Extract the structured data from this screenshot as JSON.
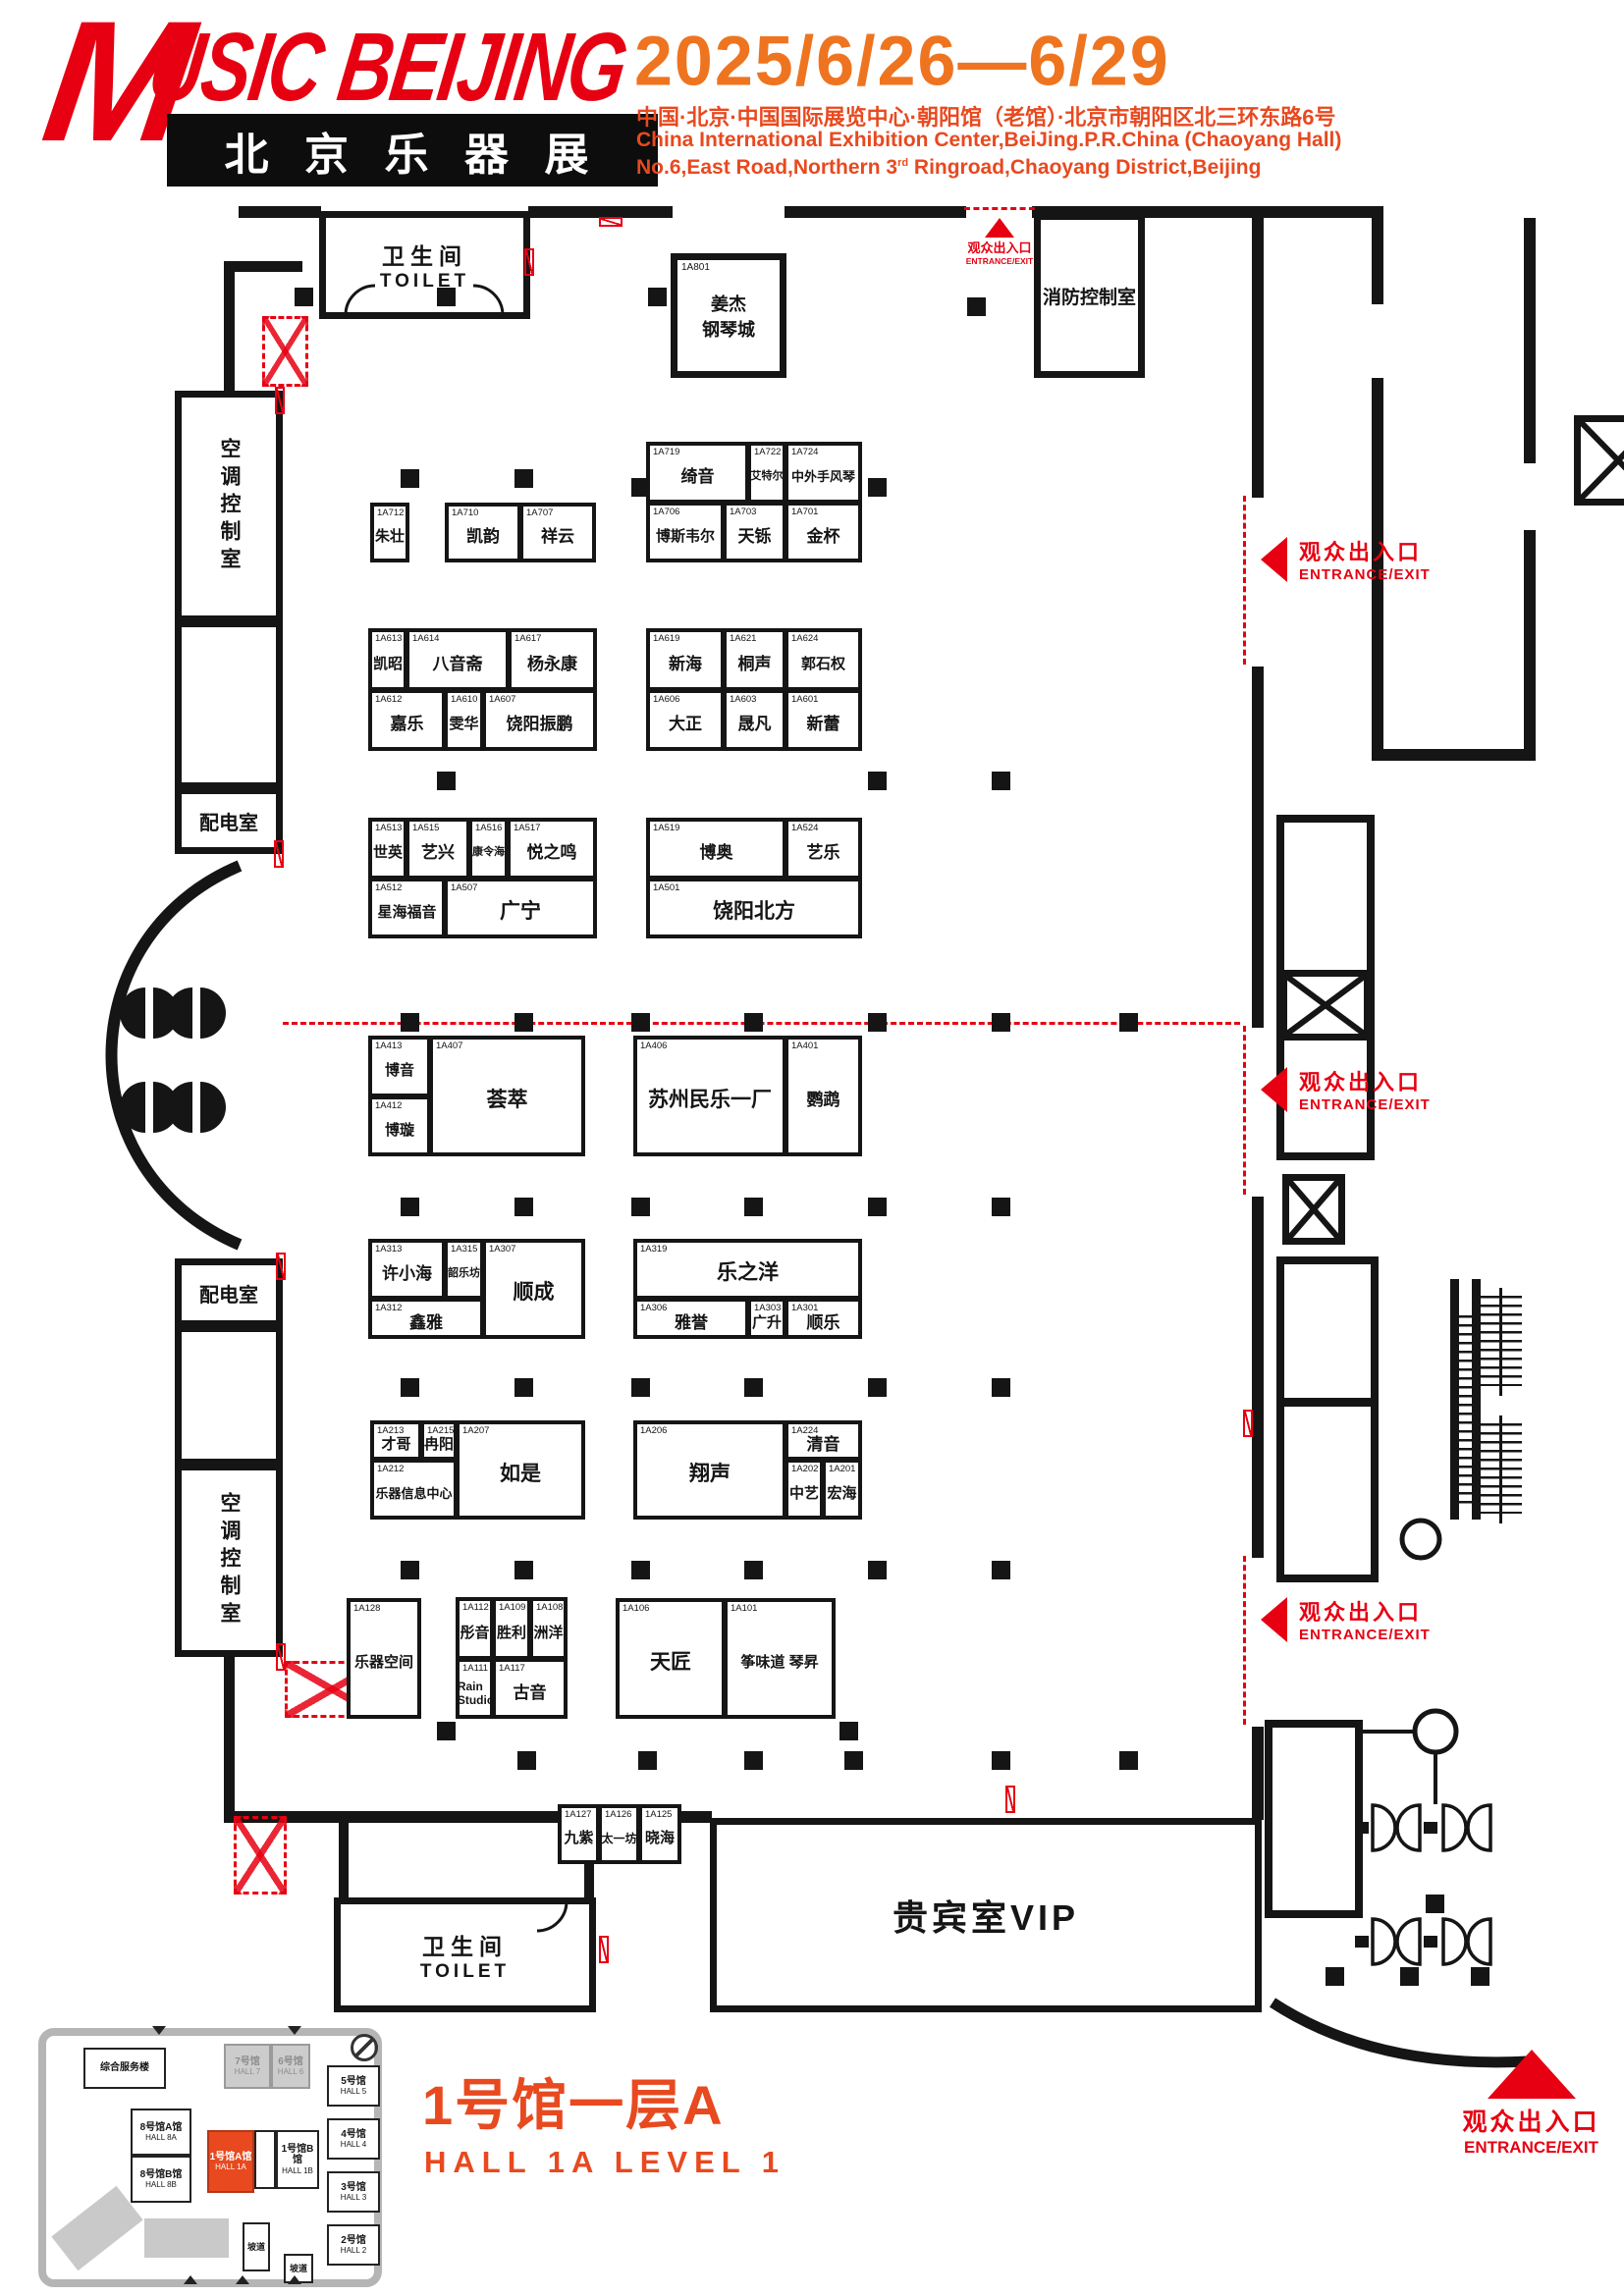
{
  "header": {
    "logo_main_initial": "M",
    "logo_main_rest": "USIC BEIJING",
    "logo_sub": "北 京 乐 器 展",
    "dates": "2025/6/26—6/29",
    "address_cn": "中国·北京·中国国际展览中心·朝阳馆（老馆）·北京市朝阳区北三环东路6号",
    "address_en1": "China International Exhibition Center,BeiJing.P.R.China (Chaoyang Hall)",
    "address_en2_a": "No.6,East Road,Northern 3",
    "address_en2_sup": "rd",
    "address_en2_b": " Ringroad,Chaoyang District,Beijing"
  },
  "entrance": {
    "cn": "观众出入口",
    "en": "ENTRANCE/EXIT"
  },
  "rooms": {
    "toilet_cn": "卫生间",
    "toilet_en": "TOILET",
    "piano_id": "1A801",
    "piano_l1": "姜杰",
    "piano_l2": "钢琴城",
    "fire": "消防控制室",
    "hvac": "空调控制室",
    "power": "配电室",
    "vip": "贵宾室VIP"
  },
  "title": {
    "cn": "1号馆一层A",
    "en": "HALL 1A LEVEL 1"
  },
  "minimap": {
    "service": "综合服务楼",
    "ramp": "坡道",
    "halls": [
      {
        "cn": "7号馆",
        "en": "HALL 7"
      },
      {
        "cn": "6号馆",
        "en": "HALL 6"
      },
      {
        "cn": "5号馆",
        "en": "HALL 5"
      },
      {
        "cn": "4号馆",
        "en": "HALL 4"
      },
      {
        "cn": "3号馆",
        "en": "HALL 3"
      },
      {
        "cn": "2号馆",
        "en": "HALL 2"
      },
      {
        "cn": "8号馆A馆",
        "en": "HALL 8A"
      },
      {
        "cn": "8号馆B馆",
        "en": "HALL 8B"
      },
      {
        "cn": "1号馆A馆",
        "en": "HALL 1A"
      },
      {
        "cn": "1号馆B馆",
        "en": "HALL 1B"
      }
    ]
  },
  "colors": {
    "brand_red": "#e60012",
    "date_orange": "#ee7420",
    "address_red": "#e8491f",
    "wall_black": "#151515"
  },
  "booths": [
    {
      "id": "1A712",
      "name": "朱壮"
    },
    {
      "id": "1A710",
      "name": "凯韵"
    },
    {
      "id": "1A707",
      "name": "祥云"
    },
    {
      "id": "1A719",
      "name": "绮音"
    },
    {
      "id": "1A722",
      "name": "艾特尔"
    },
    {
      "id": "1A724",
      "name": "中外手风琴"
    },
    {
      "id": "1A706",
      "name": "博斯韦尔"
    },
    {
      "id": "1A703",
      "name": "天铄"
    },
    {
      "id": "1A701",
      "name": "金杯"
    },
    {
      "id": "1A613",
      "name": "凯昭"
    },
    {
      "id": "1A614",
      "name": "八音斋"
    },
    {
      "id": "1A617",
      "name": "杨永康"
    },
    {
      "id": "1A612",
      "name": "嘉乐"
    },
    {
      "id": "1A610",
      "name": "雯华"
    },
    {
      "id": "1A607",
      "name": "饶阳振鹏"
    },
    {
      "id": "1A619",
      "name": "新海"
    },
    {
      "id": "1A621",
      "name": "桐声"
    },
    {
      "id": "1A624",
      "name": "郭石权"
    },
    {
      "id": "1A606",
      "name": "大正"
    },
    {
      "id": "1A603",
      "name": "晟凡"
    },
    {
      "id": "1A601",
      "name": "新蕾"
    },
    {
      "id": "1A513",
      "name": "世英"
    },
    {
      "id": "1A515",
      "name": "艺兴"
    },
    {
      "id": "1A516",
      "name": "康令海"
    },
    {
      "id": "1A517",
      "name": "悦之鸣"
    },
    {
      "id": "1A512",
      "name": "星海福音"
    },
    {
      "id": "1A507",
      "name": "广宁"
    },
    {
      "id": "1A519",
      "name": "博奥"
    },
    {
      "id": "1A524",
      "name": "艺乐"
    },
    {
      "id": "1A501",
      "name": "饶阳北方"
    },
    {
      "id": "1A413",
      "name": "博音"
    },
    {
      "id": "1A412",
      "name": "博璇"
    },
    {
      "id": "1A407",
      "name": "荟萃"
    },
    {
      "id": "1A406",
      "name": "苏州民乐一厂"
    },
    {
      "id": "1A401",
      "name": "鹦鹉"
    },
    {
      "id": "1A313",
      "name": "许小海"
    },
    {
      "id": "1A315",
      "name": "韶乐坊"
    },
    {
      "id": "1A307",
      "name": "顺成"
    },
    {
      "id": "1A312",
      "name": "鑫雅"
    },
    {
      "id": "1A319",
      "name": "乐之洋"
    },
    {
      "id": "1A306",
      "name": "雅誉"
    },
    {
      "id": "1A303",
      "name": "广升"
    },
    {
      "id": "1A301",
      "name": "顺乐"
    },
    {
      "id": "1A213",
      "name": "才哥"
    },
    {
      "id": "1A215",
      "name": "冉阳"
    },
    {
      "id": "1A207",
      "name": "如是"
    },
    {
      "id": "1A212",
      "name": "乐器信息中心"
    },
    {
      "id": "1A206",
      "name": "翔声"
    },
    {
      "id": "1A224",
      "name": "清音"
    },
    {
      "id": "1A202",
      "name": "中艺"
    },
    {
      "id": "1A201",
      "name": "宏海"
    },
    {
      "id": "1A128",
      "name": "乐器空间"
    },
    {
      "id": "1A112",
      "name": "彤音"
    },
    {
      "id": "1A109",
      "name": "胜利"
    },
    {
      "id": "1A108",
      "name": "洲洋"
    },
    {
      "id": "1A111",
      "name": "Rain Studio"
    },
    {
      "id": "1A117",
      "name": "古音"
    },
    {
      "id": "1A106",
      "name": "天匠"
    },
    {
      "id": "1A101",
      "name": "筝味道 琴昇"
    },
    {
      "id": "1A127",
      "name": "九紫"
    },
    {
      "id": "1A126",
      "name": "太一坊"
    },
    {
      "id": "1A125",
      "name": "晓海"
    }
  ]
}
